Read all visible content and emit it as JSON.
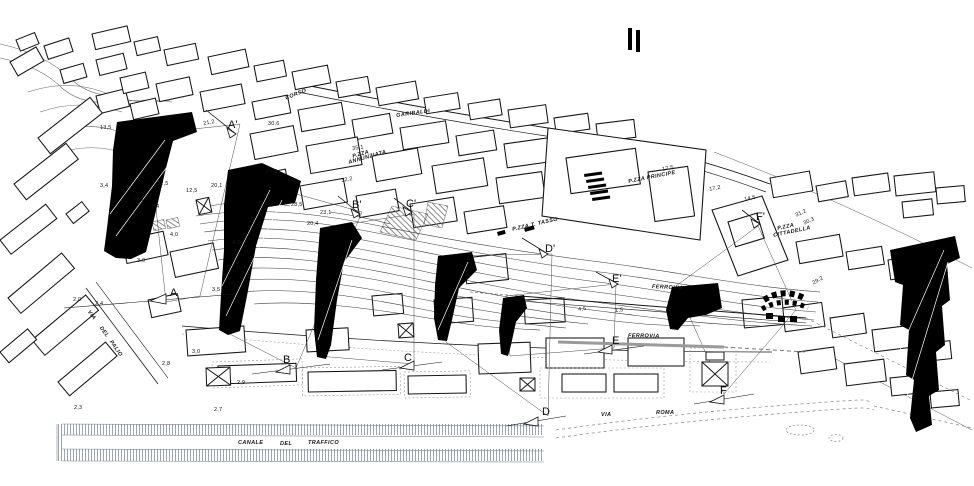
{
  "colors": {
    "ink": "#111111",
    "paper": "#ffffff",
    "contour": "#3c3c3c",
    "water_hatch": "#9aa6b1",
    "light_gray": "#8d9399"
  },
  "sections": {
    "top": [
      {
        "label": "A'"
      },
      {
        "label": "B'"
      },
      {
        "label": "C'"
      },
      {
        "label": "D'"
      },
      {
        "label": "E'"
      },
      {
        "label": "F'"
      }
    ],
    "bottom": [
      {
        "label": "A"
      },
      {
        "label": "B"
      },
      {
        "label": "C"
      },
      {
        "label": "D"
      },
      {
        "label": "E"
      },
      {
        "label": "F"
      }
    ]
  },
  "names": {
    "corso": "CORSO",
    "garibaldi": "GARIBALDI",
    "pzza": "P.ZZA",
    "annunziata": "ANNUNZIATA",
    "principe": "P.ZZA PRINCIPE",
    "tasso": "P.ZZA T. TASSO",
    "cittadella": "CITTADELLA",
    "ferrovia": "FERROVIA",
    "via": "VIA",
    "roma": "ROMA",
    "del": "DEL",
    "palio": "PALIO",
    "canale": "CANALE",
    "traffico": "TRAFFICO"
  },
  "elevations": [
    {
      "v": "13,5"
    },
    {
      "v": "21,2"
    },
    {
      "v": "30,6"
    },
    {
      "v": "3,4"
    },
    {
      "v": "12,5"
    },
    {
      "v": "12,5"
    },
    {
      "v": "20,1"
    },
    {
      "v": "25,8"
    },
    {
      "v": "8,5"
    },
    {
      "v": "7,4"
    },
    {
      "v": "28,5"
    },
    {
      "v": "23,1"
    },
    {
      "v": "20,4"
    },
    {
      "v": "4,0"
    },
    {
      "v": "4,0"
    },
    {
      "v": "35,1"
    },
    {
      "v": "32,2"
    },
    {
      "v": "3,0"
    },
    {
      "v": "2,0"
    },
    {
      "v": "2,4"
    },
    {
      "v": "3,5"
    },
    {
      "v": "3,0"
    },
    {
      "v": "2,8"
    },
    {
      "v": "2,9"
    },
    {
      "v": "2,3"
    },
    {
      "v": "2,7"
    },
    {
      "v": "17,5"
    },
    {
      "v": "17,2"
    },
    {
      "v": "14,5"
    },
    {
      "v": "31,2"
    },
    {
      "v": "30,3"
    },
    {
      "v": "29,2"
    },
    {
      "v": "4,5"
    },
    {
      "v": "1,5"
    }
  ]
}
